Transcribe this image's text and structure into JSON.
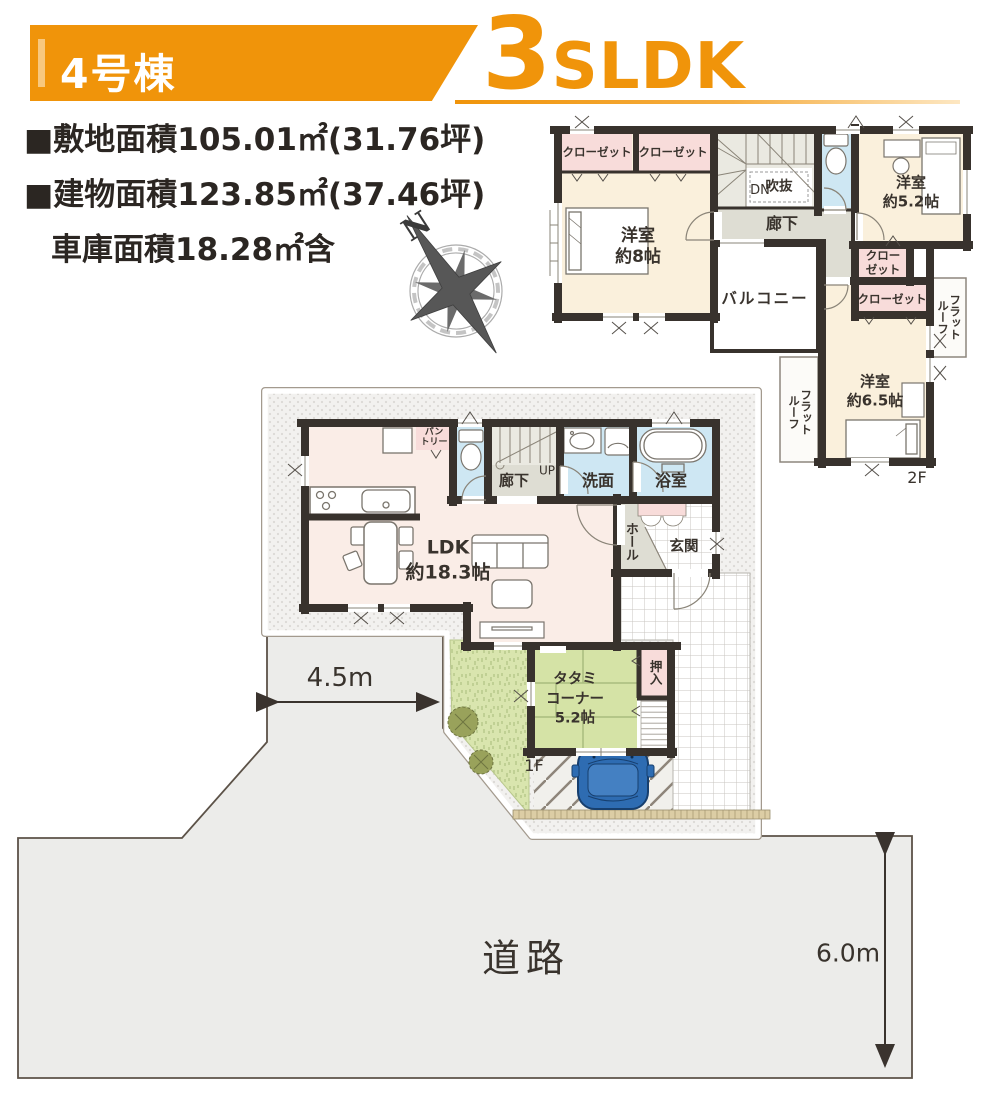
{
  "header": {
    "unit_label": "4号棟",
    "plan_number": "3",
    "plan_suffix": "SLDK"
  },
  "site_info": {
    "line1": "■敷地面積105.01㎡(31.76坪)",
    "line2": "■建物面積123.85㎡(37.46坪)",
    "line3": "車庫面積18.28㎡含"
  },
  "compass": {
    "north": "N"
  },
  "floor2": {
    "floor_label": "2F",
    "closet_a": "クローゼット",
    "closet_b": "クローゼット",
    "stairs_down": "DN",
    "void": "吹抜",
    "hallway": "廊下",
    "bedroom8": "洋室\n約8帖",
    "bedroom52": "洋室\n約5.2帖",
    "bedroom65": "洋室\n約6.5帖",
    "balcony": "バルコニー",
    "closet_c": "クロー\nゼット",
    "closet_d": "クローゼット",
    "flat_roof_right": "フラットルーフ",
    "flat_roof_left": "フラットルーフ"
  },
  "floor1": {
    "floor_label": "1F",
    "pantry": "パン\nトリー",
    "hallway": "廊下",
    "stairs_up": "UP",
    "washroom": "洗面",
    "bathroom": "浴室",
    "hall": "ホール",
    "entrance": "玄関",
    "ldk": "LDK\n約18.3帖",
    "tatami": "タタミ\nコーナー\n5.2帖",
    "oshiire": "押入"
  },
  "site": {
    "road": "道路",
    "frontage": "4.5m",
    "road_width": "6.0m"
  },
  "colors": {
    "accent_orange": "#F0940A",
    "wall": "#38322D",
    "room_cream": "#FAF0DC",
    "ldk_pink": "#FAEDE7",
    "closet_pink": "#F8DCDA",
    "wet_blue": "#CEE7F3",
    "corridor_gray": "#DEDDD3",
    "tatami_green": "#D5E3A6",
    "garden_green": "#D9E5AE",
    "road_gray": "#ECECEA",
    "car_blue": "#2E6CB2"
  }
}
